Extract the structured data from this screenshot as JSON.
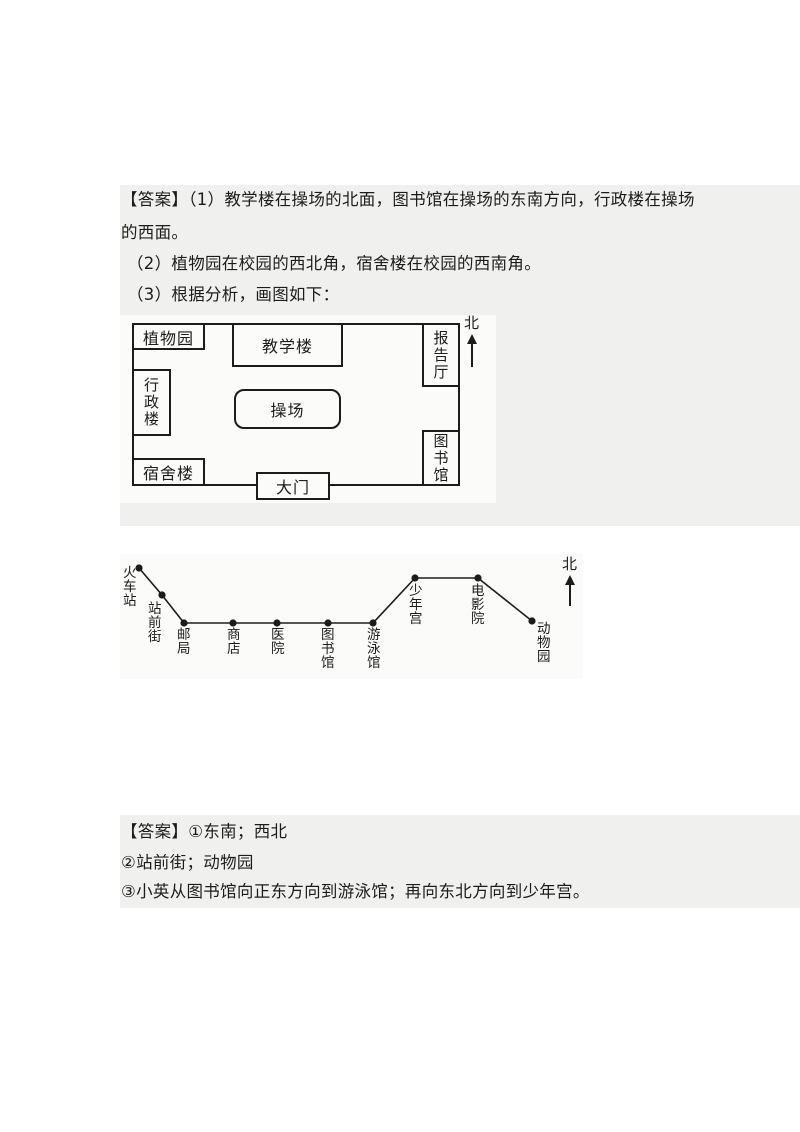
{
  "colors": {
    "page_bg": "#ffffff",
    "panel_bg": "#f0f0ee",
    "diagram_bg": "#fbfbfa",
    "ink": "#1c1c1a"
  },
  "answer1": {
    "lines": [
      "【答案】（1）教学楼在操场的北面，图书馆在操场的东南方向，行政楼在操场",
      "的西面。",
      "（2）植物园在校园的西北角，宿舍楼在校园的西南角。",
      "（3）根据分析，画图如下："
    ]
  },
  "campus_map": {
    "north_label": "北",
    "outer": {
      "x": 12,
      "y": 8,
      "w": 328,
      "h": 163
    },
    "buildings": [
      {
        "id": "botanical-garden",
        "label": "植物园",
        "x": 12,
        "y": 8,
        "w": 73,
        "h": 27,
        "orient": "h"
      },
      {
        "id": "teaching-building",
        "label": "教学楼",
        "x": 112,
        "y": 8,
        "w": 111,
        "h": 44,
        "orient": "h"
      },
      {
        "id": "lecture-hall",
        "label": "报告厅",
        "x": 302,
        "y": 8,
        "w": 38,
        "h": 64,
        "orient": "v"
      },
      {
        "id": "admin-building",
        "label": "行政楼",
        "x": 12,
        "y": 54,
        "w": 39,
        "h": 67,
        "orient": "v"
      },
      {
        "id": "playground",
        "label": "操场",
        "x": 114,
        "y": 74,
        "w": 107,
        "h": 40,
        "orient": "h",
        "rounded": true
      },
      {
        "id": "dormitory",
        "label": "宿舍楼",
        "x": 12,
        "y": 143,
        "w": 73,
        "h": 28,
        "orient": "h"
      },
      {
        "id": "gate",
        "label": "大门",
        "x": 136,
        "y": 157,
        "w": 74,
        "h": 28,
        "orient": "h"
      },
      {
        "id": "library",
        "label": "图书馆",
        "x": 302,
        "y": 115,
        "w": 38,
        "h": 56,
        "orient": "v"
      }
    ],
    "north_pos": {
      "x": 344,
      "y": 0,
      "shaft_h": 23
    }
  },
  "route_map": {
    "north_label": "北",
    "stops": [
      {
        "name": "火车站",
        "dot": [
          19,
          14
        ],
        "label": [
          3,
          12
        ]
      },
      {
        "name": "站前街",
        "dot": [
          42,
          41
        ],
        "label": [
          28,
          48
        ]
      },
      {
        "name": "邮局",
        "dot": [
          64,
          69
        ],
        "label": [
          57,
          74
        ]
      },
      {
        "name": "商店",
        "dot": [
          113,
          69
        ],
        "label": [
          107,
          74
        ]
      },
      {
        "name": "医院",
        "dot": [
          157,
          69
        ],
        "label": [
          151,
          74
        ]
      },
      {
        "name": "图书馆",
        "dot": [
          208,
          69
        ],
        "label": [
          201,
          74
        ]
      },
      {
        "name": "游泳馆",
        "dot": [
          253,
          69
        ],
        "label": [
          247,
          74
        ]
      },
      {
        "name": "少年宫",
        "dot": [
          295,
          24
        ],
        "label": [
          289,
          30
        ]
      },
      {
        "name": "电影院",
        "dot": [
          358,
          24
        ],
        "label": [
          351,
          30
        ]
      },
      {
        "name": "动物园",
        "dot": [
          412,
          67
        ],
        "label": [
          417,
          68
        ]
      }
    ],
    "path": [
      [
        19,
        14
      ],
      [
        42,
        41
      ],
      [
        64,
        69
      ],
      [
        253,
        69
      ],
      [
        295,
        24
      ],
      [
        358,
        24
      ],
      [
        412,
        67
      ]
    ],
    "north_pos": {
      "x": 442,
      "y": 2,
      "shaft_h": 21
    }
  },
  "answer2": {
    "lines": [
      "【答案】①东南；西北",
      "②站前街；动物园",
      "③小英从图书馆向正东方向到游泳馆；再向东北方向到少年宫。"
    ]
  }
}
